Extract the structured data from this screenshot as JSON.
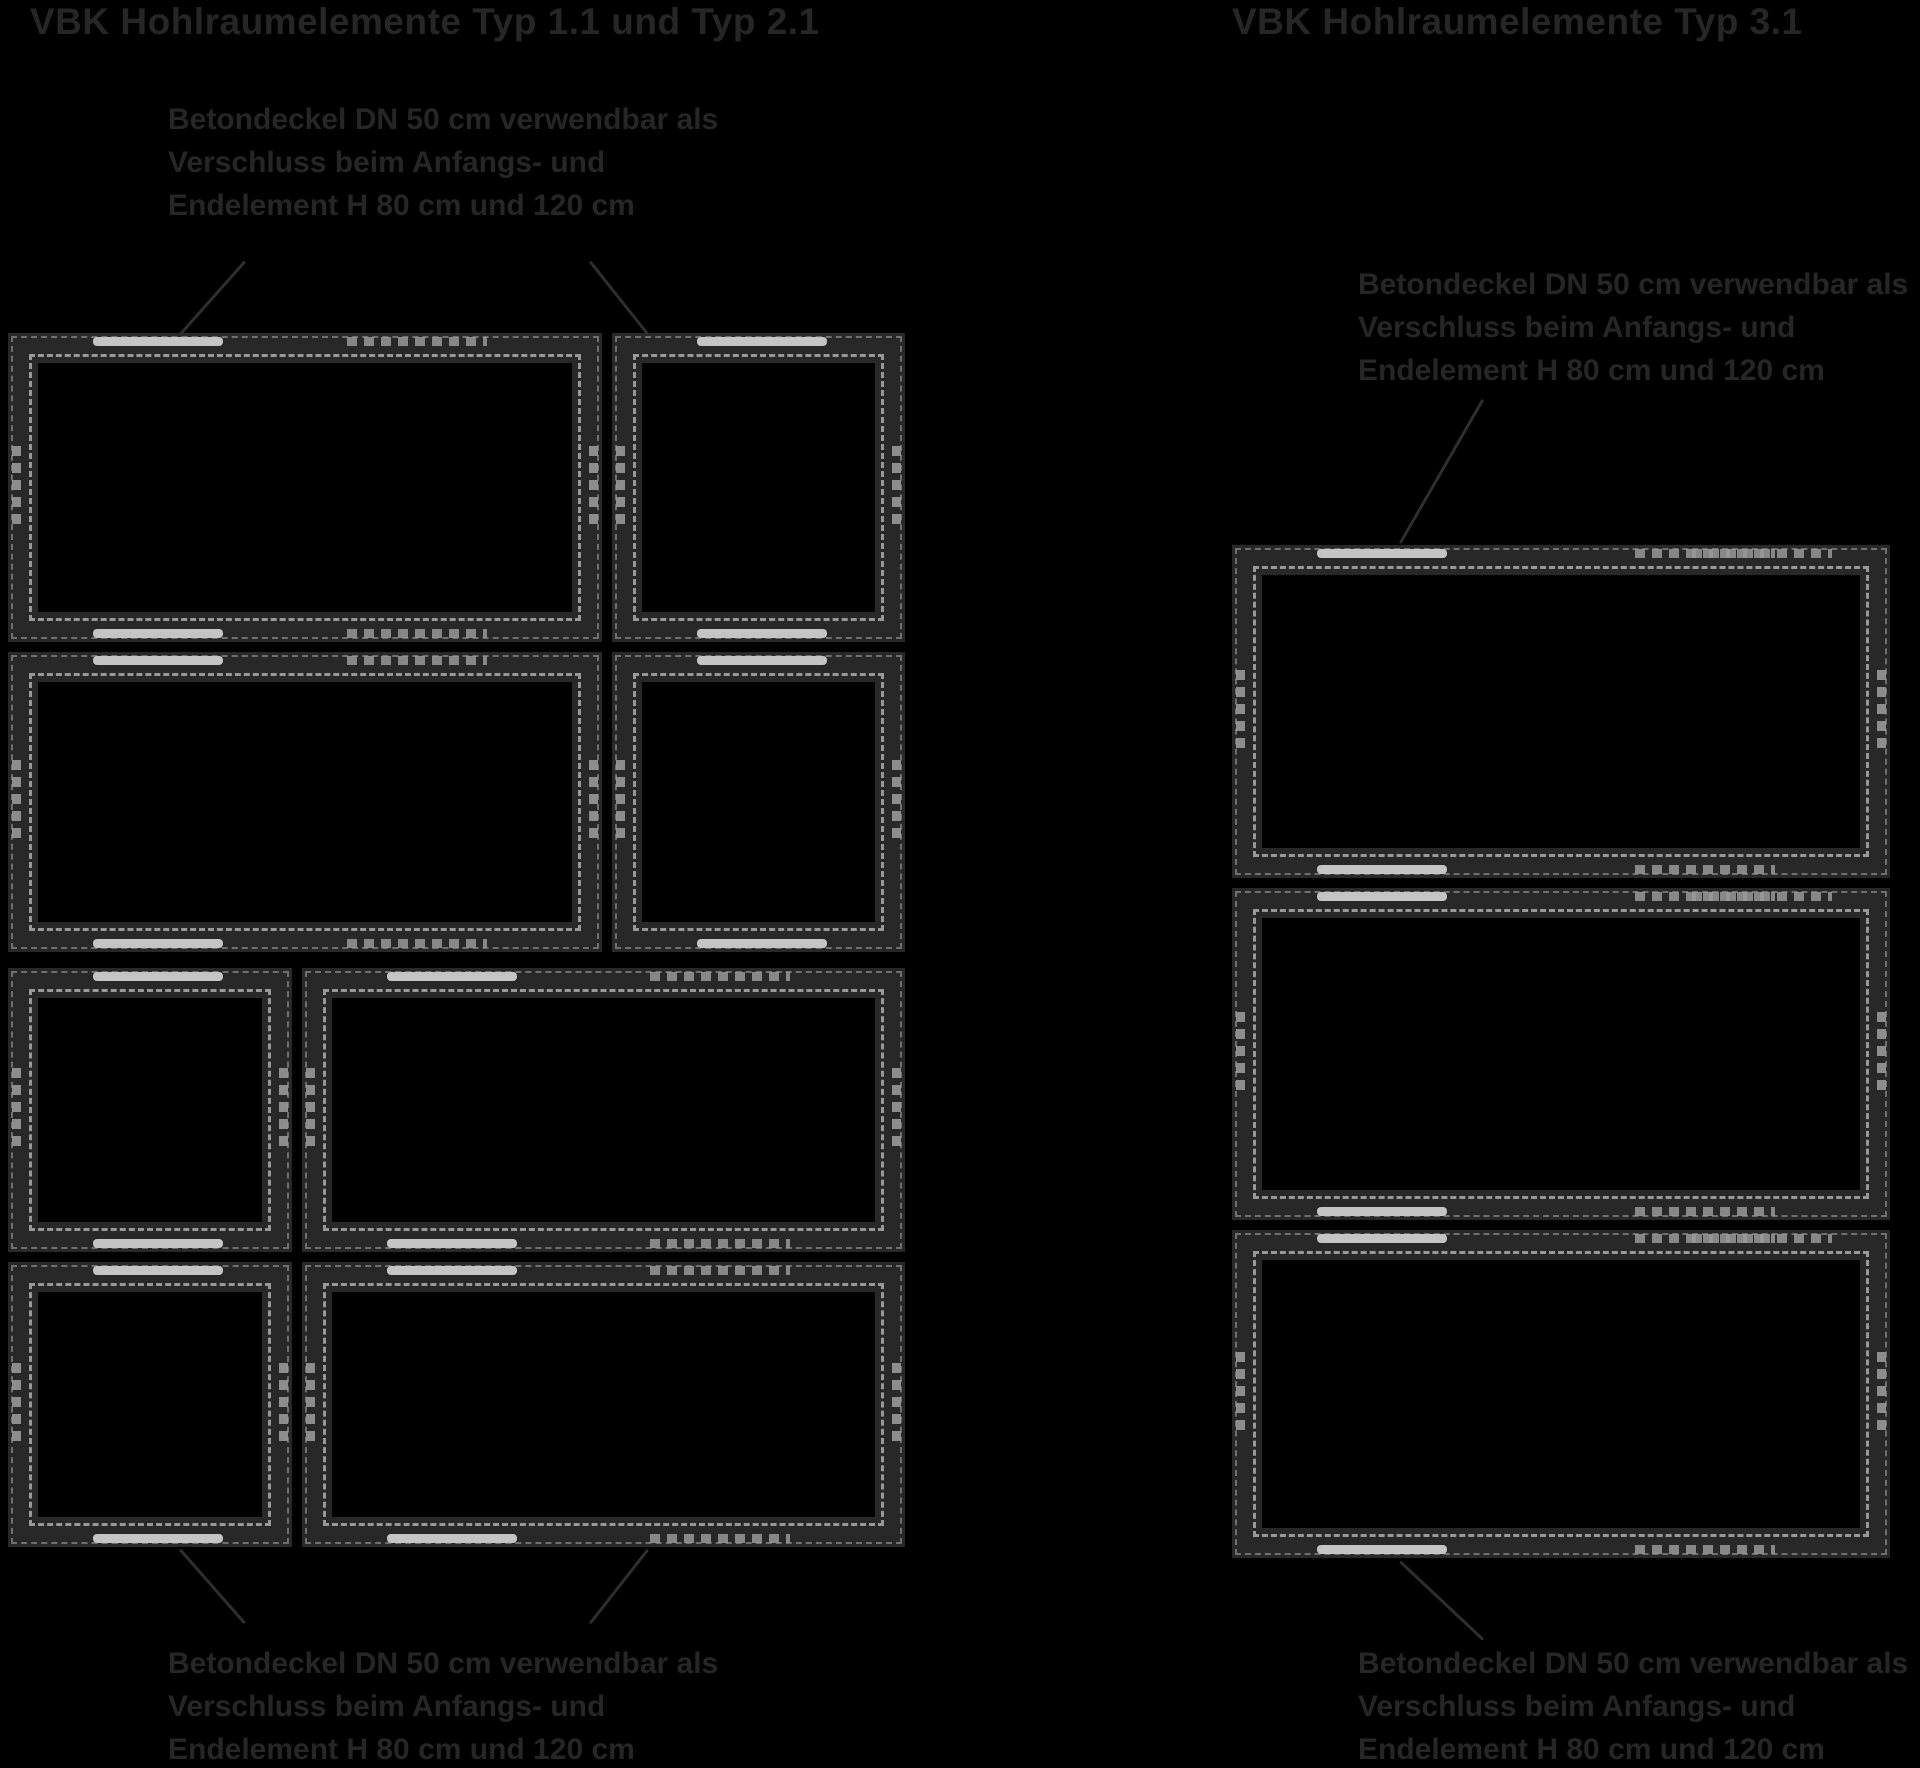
{
  "figures": {
    "left": {
      "title": "VBK Hohlraumelemente Typ 1.1 und Typ 2.1",
      "top_label": {
        "line1": "Betondeckel DN 50 cm verwendbar als",
        "line2": "Verschluss beim Anfangs- und",
        "line3": "Endelement H 80 cm und 120 cm"
      },
      "bottom_label": {
        "line1": "Betondeckel DN 50 cm verwendbar als",
        "line2": "Verschluss beim Anfangs- und",
        "line3": "Endelement H 80 cm und 120 cm"
      }
    },
    "right": {
      "title": "VBK Hohlraumelemente Typ 3.1",
      "top_label": {
        "line1": "Betondeckel DN 50 cm verwendbar als",
        "line2": "Verschluss beim Anfangs- und",
        "line3": "Endelement H 80 cm und 120 cm"
      },
      "bottom_label": {
        "line1": "Betondeckel DN 50 cm verwendbar als",
        "line2": "Verschluss beim Anfangs- und",
        "line3": "Endelement H 80 cm und 120 cm"
      }
    }
  },
  "colors": {
    "background": "#000000",
    "frame": "#282828",
    "dash_light": "#989898",
    "dash_dim": "#6f6f6f",
    "joint_bar": "#c4c4c4",
    "text": "#262626",
    "leader": "#2e2e2e"
  }
}
